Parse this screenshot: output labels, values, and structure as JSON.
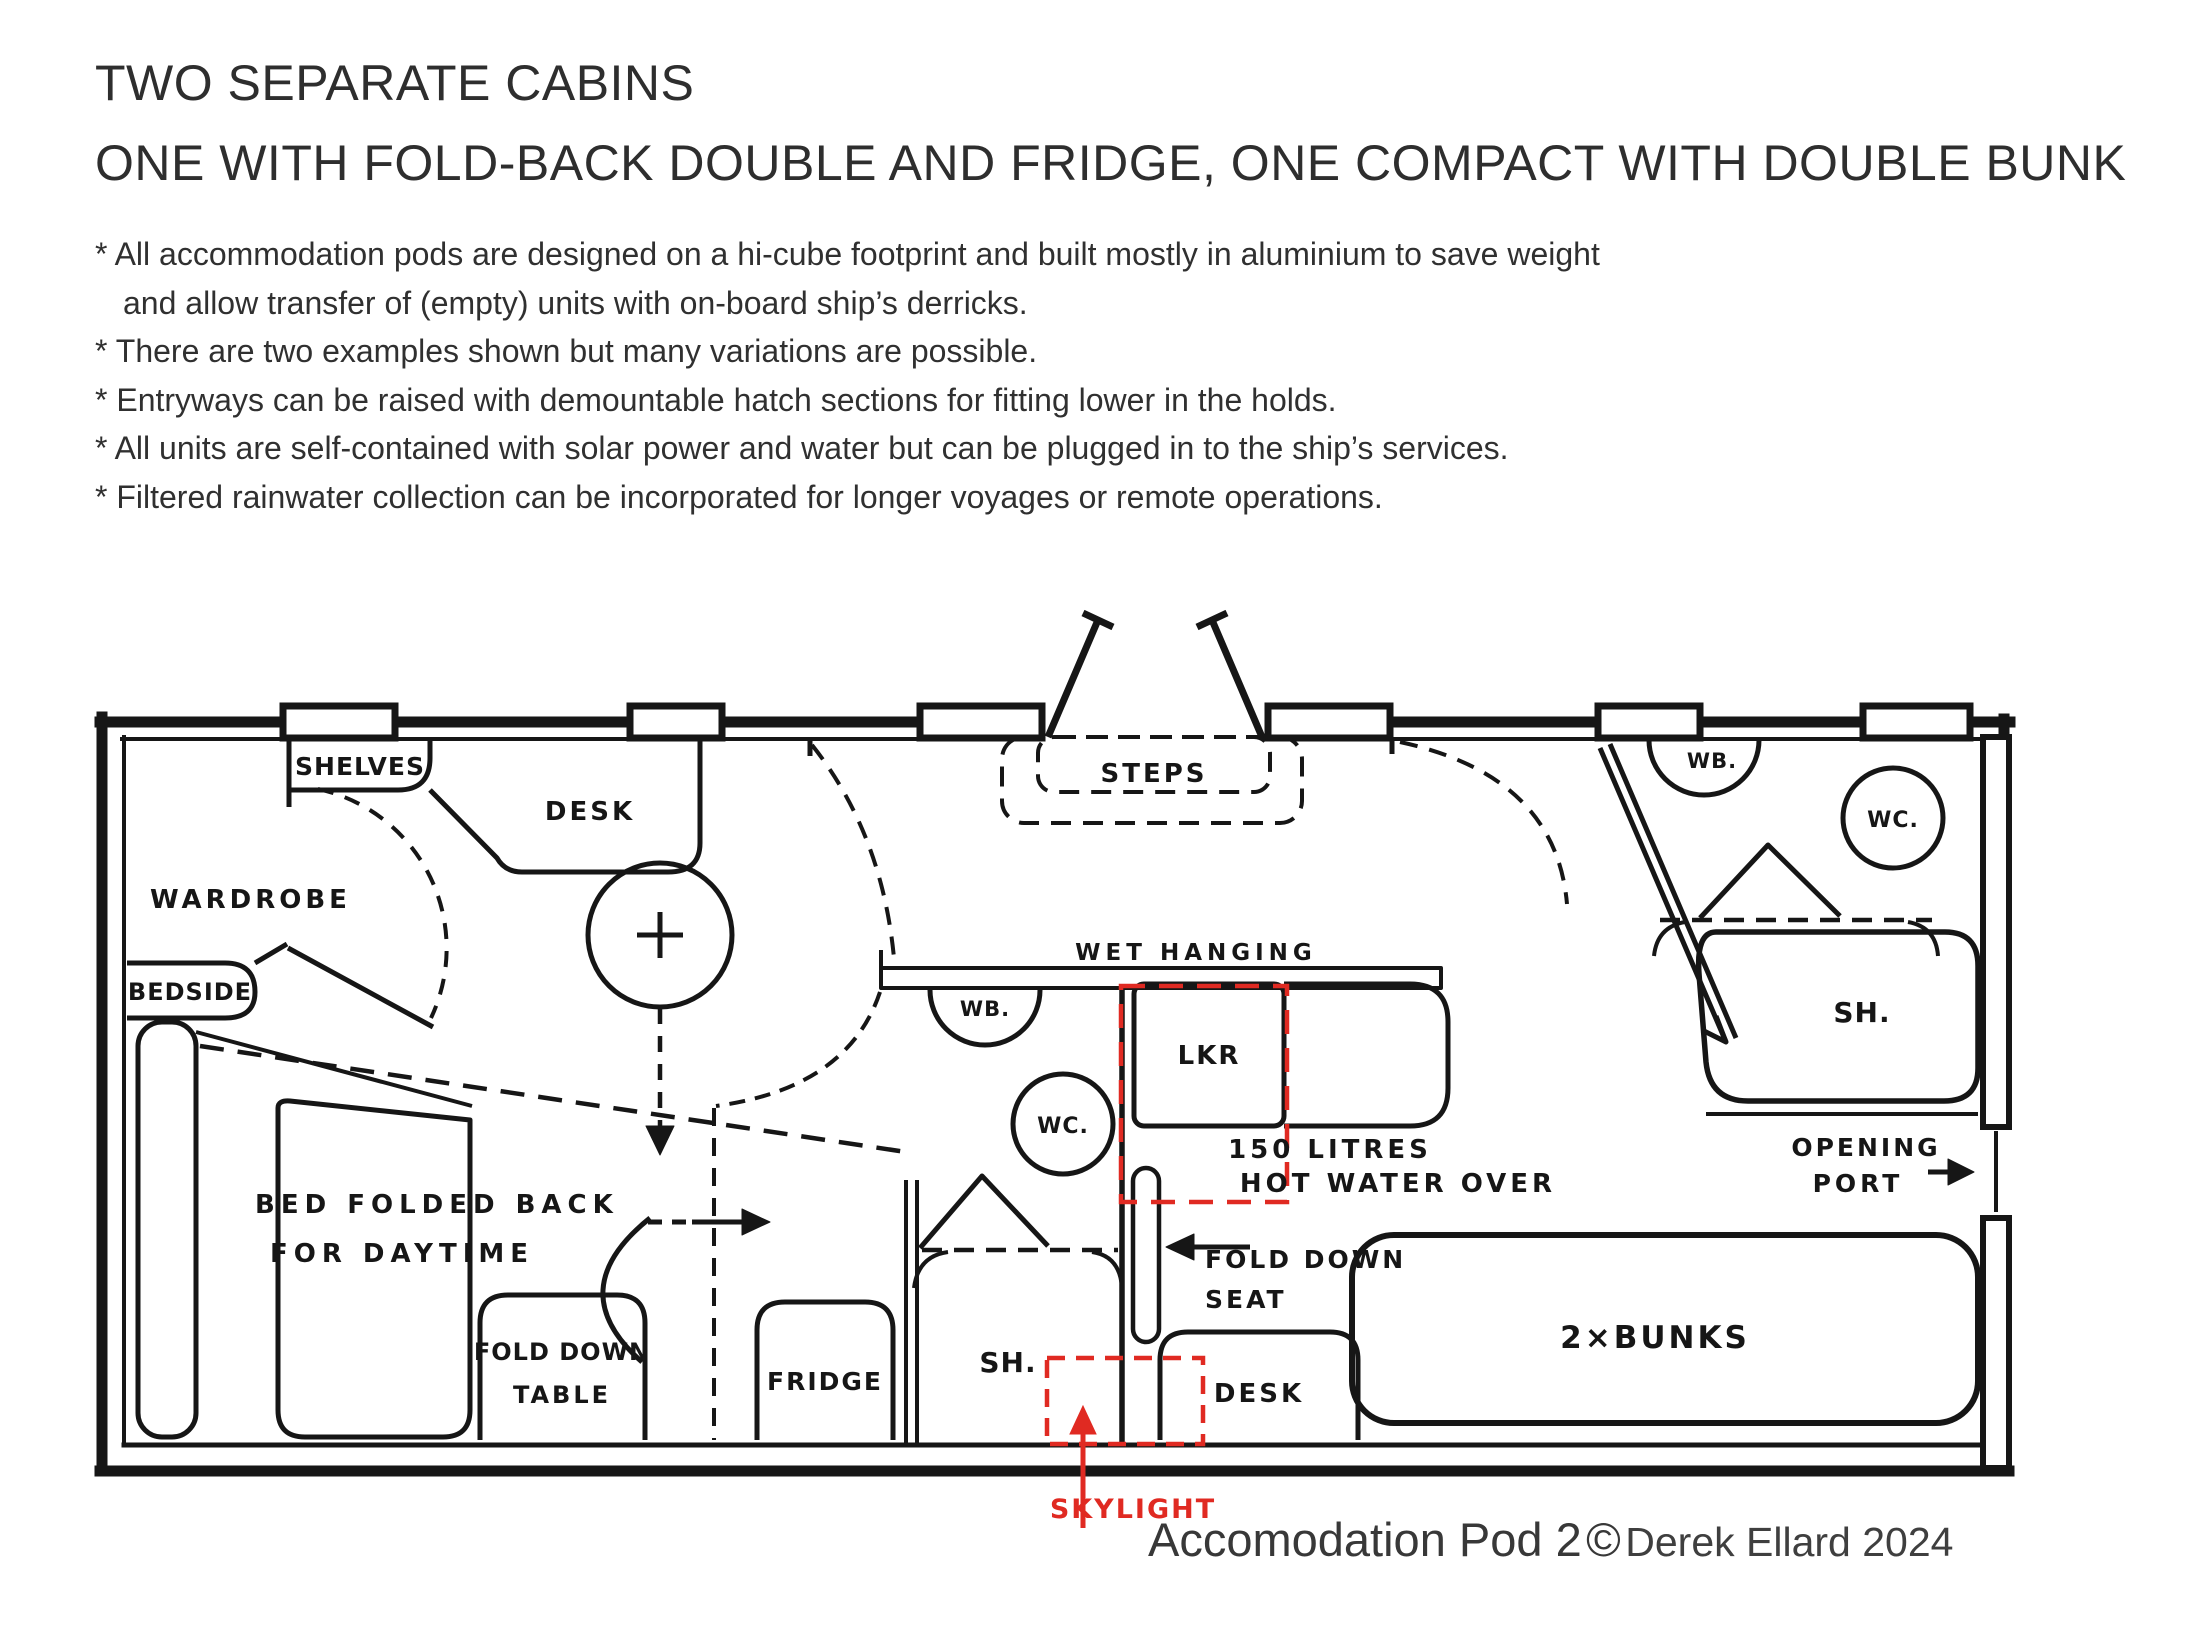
{
  "header": {
    "title_line1": "TWO SEPARATE CABINS",
    "title_line2": "ONE WITH FOLD-BACK DOUBLE AND FRIDGE, ONE COMPACT WITH DOUBLE BUNK",
    "notes": [
      {
        "text": "* All accommodation pods are designed on a hi-cube footprint and built mostly in aluminium to save weight"
      },
      {
        "text": "and allow transfer of (empty) units with on-board ship’s derricks."
      },
      {
        "text": "* There are two examples shown but many variations are possible."
      },
      {
        "text": "* Entryways can be raised with demountable hatch sections for fitting lower in the holds."
      },
      {
        "text": "* All units are self-contained with solar power and water but can be plugged in to the ship’s services."
      },
      {
        "text": "* Filtered rainwater collection can be incorporated for longer voyages or remote operations."
      }
    ]
  },
  "plan": {
    "colors": {
      "ink": "#161616",
      "highlight": "#e02a22"
    },
    "labels": {
      "shelves": "SHELVES",
      "desk1": "DESK",
      "wardrobe": "WARDROBE",
      "bedside": "BEDSIDE",
      "steps": "STEPS",
      "wet_hanging": "WET HANGING",
      "wb_mid": "WB.",
      "wc_mid": "WC.",
      "lkr": "LKR",
      "litres": "150 LITRES",
      "hot_water": "HOT WATER OVER",
      "bed_folded_1": "BED FOLDED BACK",
      "bed_folded_2": "FOR DAYTIME",
      "fold_table_1": "FOLD DOWN",
      "fold_table_2": "TABLE",
      "fridge": "FRIDGE",
      "sh_mid": "SH.",
      "skylight": "SKYLIGHT",
      "fold_seat_1": "FOLD DOWN",
      "fold_seat_2": "SEAT",
      "desk2": "DESK",
      "bunks": "2×BUNKS",
      "opening_1": "OPENING",
      "opening_2": "PORT",
      "wb_right": "WB.",
      "wc_right": "WC.",
      "sh_right": "SH."
    }
  },
  "caption": {
    "title": "Accomodation Pod 2",
    "copyright": "©",
    "author": "Derek Ellard 2024"
  }
}
